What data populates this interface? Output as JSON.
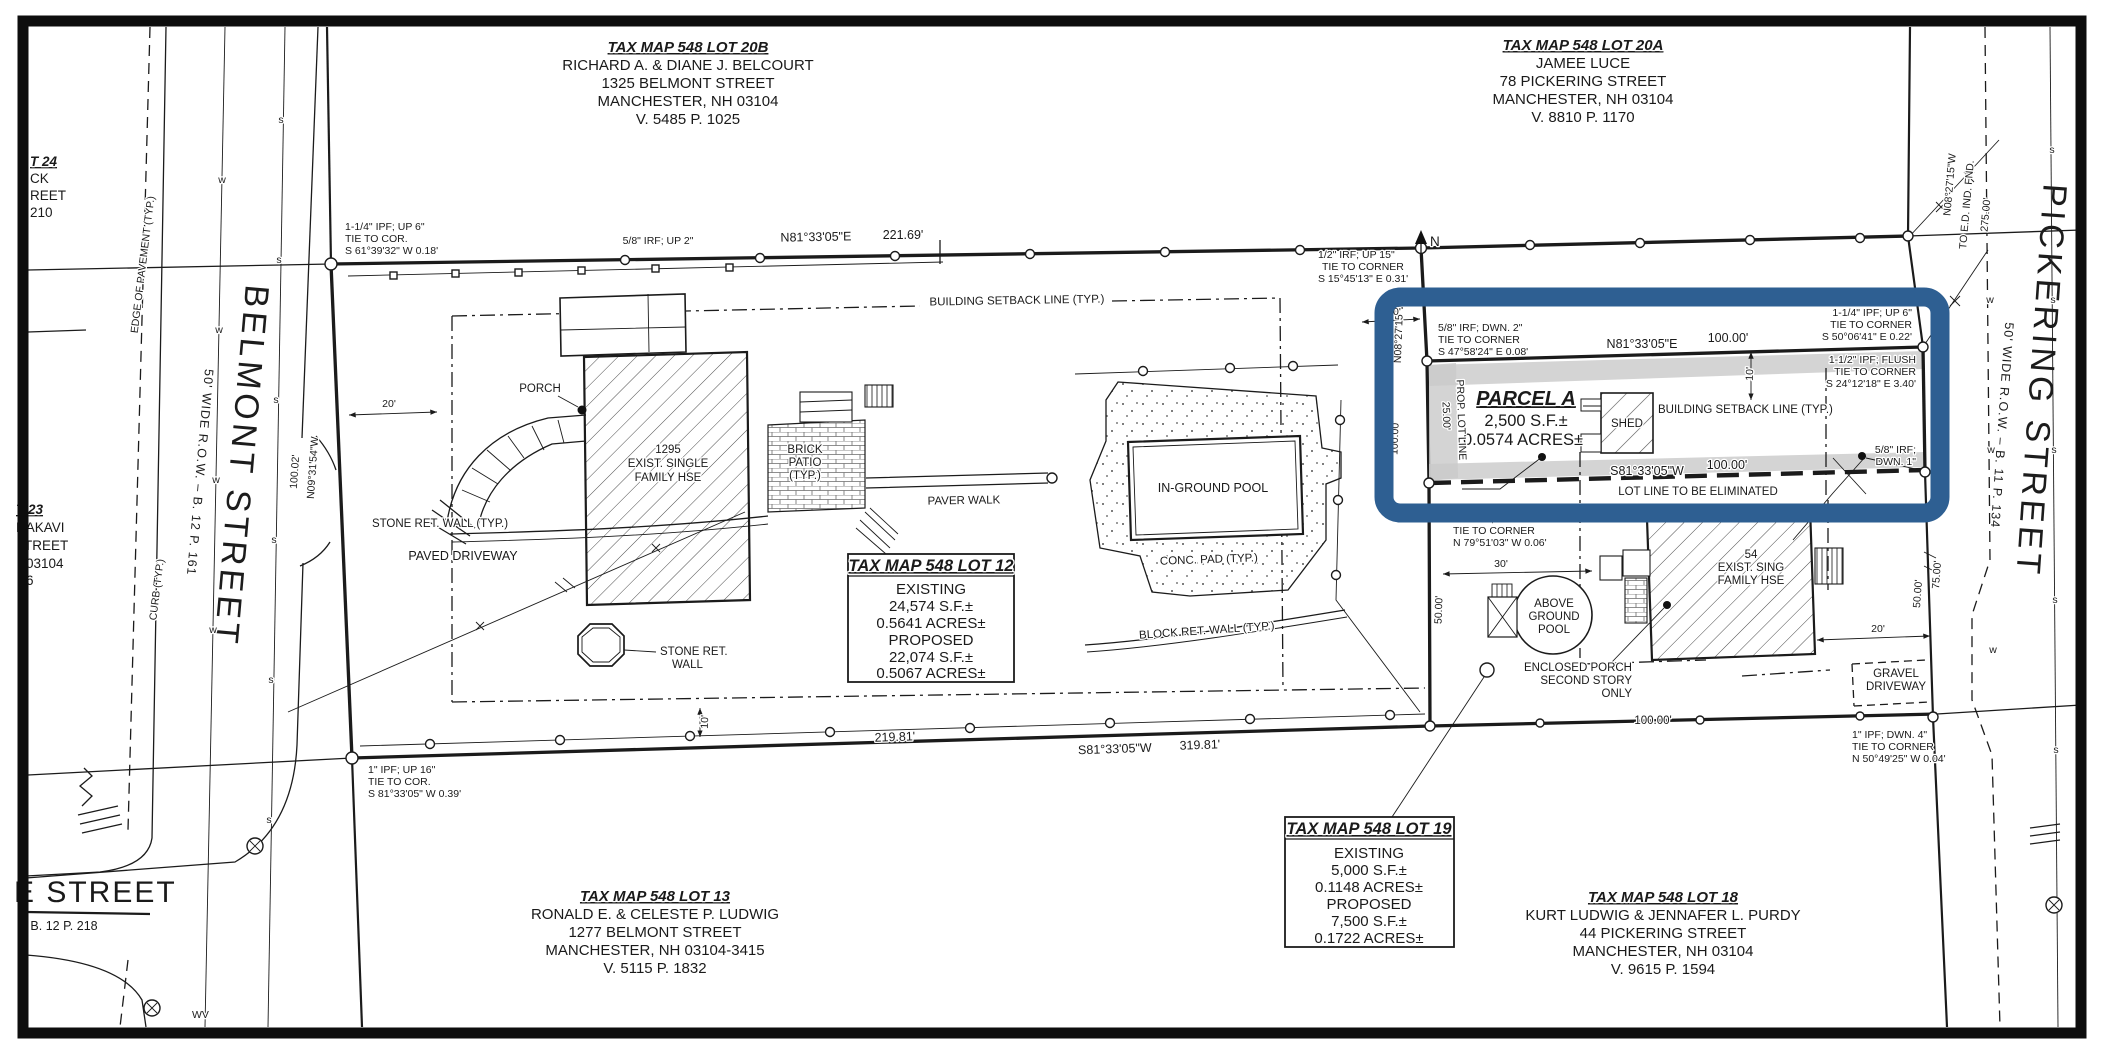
{
  "colors": {
    "highlight": "#2e5f92",
    "paper": "#ffffff",
    "ink": "#1a1a1a"
  },
  "owner_blocks": {
    "lot20b": {
      "title": "TAX MAP 548 LOT 20B",
      "lines": [
        "RICHARD A. & DIANE J. BELCOURT",
        "1325 BELMONT STREET",
        "MANCHESTER, NH 03104",
        "V. 5485 P. 1025"
      ]
    },
    "lot20a": {
      "title": "TAX MAP 548 LOT 20A",
      "lines": [
        "JAMEE LUCE",
        "78 PICKERING STREET",
        "MANCHESTER, NH 03104",
        "V. 8810 P. 1170"
      ]
    },
    "lot13": {
      "title": "TAX MAP 548 LOT 13",
      "lines": [
        "RONALD E. & CELESTE P. LUDWIG",
        "1277 BELMONT STREET",
        "MANCHESTER, NH 03104-3415",
        "V. 5115  P. 1832"
      ]
    },
    "lot18": {
      "title": "TAX MAP 548 LOT 18",
      "lines": [
        "KURT LUDWIG & JENNAFER L. PURDY",
        "44 PICKERING STREET",
        "MANCHESTER, NH 03104",
        "V. 9615 P. 1594"
      ]
    }
  },
  "area_boxes": {
    "lot12": {
      "title": "TAX MAP 548 LOT 12",
      "rows": [
        "EXISTING",
        "24,574 S.F.±",
        "0.5641 ACRES±",
        "PROPOSED",
        "22,074 S.F.±",
        "0.5067 ACRES±"
      ]
    },
    "lot19": {
      "title": "TAX MAP 548 LOT 19",
      "rows": [
        "EXISTING",
        "5,000 S.F.±",
        "0.1148 ACRES±",
        "PROPOSED",
        "7,500 S.F.±",
        "0.1722 ACRES±"
      ]
    }
  },
  "parcel_a": {
    "name": "PARCEL A",
    "area_sf": "2,500 S.F.±",
    "area_acres": "0.0574 ACRES±",
    "shed": "SHED",
    "prop_lot_line": "PROP. LOT LINE",
    "eliminate": "LOT LINE TO BE ELIMINATED"
  },
  "streets": {
    "belmont": {
      "name": "BELMONT STREET",
      "row": "50' WIDE R.O.W. – B. 12 P. 161"
    },
    "pickering": {
      "name": "PICKERING STREET",
      "row": "50' WIDE R.O.W. – B. 11 P. 134"
    },
    "e_street": {
      "name": "E STREET",
      "row": "– B. 12 P. 218"
    },
    "edge_of_pavement": "EDGE OF PAVEMENT (TYP.)",
    "curb": "CURB (TYP.)",
    "wv": "WV",
    "sewer_mark": "s",
    "water_mark": "w"
  },
  "bearings": {
    "n81": "N81°33'05\"E",
    "s81": "S81°33'05\"W",
    "n08": "N08°27'15\"W",
    "n09": "N09°31'54\"W"
  },
  "dims": {
    "d10": "10'",
    "d20": "20'",
    "d25": "25.00'",
    "d30": "30'",
    "d50": "50.00'",
    "d75": "75.00'",
    "d100": "100.00'",
    "d10002": "100.02'",
    "d21981": "219.81'",
    "d22169": "221.69'",
    "d27500": "275.00'",
    "d31981": "319.81'"
  },
  "monument_notes": {
    "ipf_up6_nw": [
      "1-1/4\" IPF; UP 6\"",
      "TIE TO COR.",
      "S 61°39'32\" W 0.18'"
    ],
    "irf_up2": "5/8\" IRF; UP 2\"",
    "irf_up15": [
      "1/2\" IRF; UP 15\"",
      "TIE TO CORNER",
      "S 15°45'13\" E 0.31'"
    ],
    "irf_dwn2": [
      "5/8\" IRF; DWN. 2\"",
      "TIE TO CORNER",
      "S 47°58'24\" E 0.08'"
    ],
    "ipf_up6_ne": [
      "1-1/4\" IPF; UP 6\"",
      "TIE TO CORNER",
      "S 50°06'41\" E 0.22'"
    ],
    "ipf_flush": [
      "1-1/2\" IPF; FLUSH",
      "TIE TO CORNER",
      "S 24°12'18\" E 3.40'"
    ],
    "irf_dwn1": [
      "5/8\" IRF;",
      "DWN. 1\""
    ],
    "irf_dwn3": [
      "5/8\" IRF; DWN. 3\"",
      "TIE TO CORNER",
      "N 79°51'03\" W 0.06'"
    ],
    "ipf_up16": [
      "1\" IPF; UP 16\"",
      "TIE TO COR.",
      "S 81°33'05\" W 0.39'"
    ],
    "ipf_dwn4": [
      "1\" IPF; DWN. 4\"",
      "TIE TO CORNER",
      "N 50°49'25\" W 0.04'"
    ]
  },
  "features": {
    "setback": "BUILDING SETBACK LINE (TYP.)",
    "porch": "PORCH",
    "house12": [
      "1295",
      "EXIST. SINGLE",
      "FAMILY HSE"
    ],
    "stone_wall": "STONE RET. WALL (TYP.)",
    "paved_driveway": "PAVED DRIVEWAY",
    "brick_patio": [
      "BRICK",
      "PATIO",
      "(TYP.)"
    ],
    "paver_walk": "PAVER WALK",
    "inground_pool": "IN-GROUND POOL",
    "conc_pad": "CONC. PAD (TYP.)",
    "block_wall": "BLOCK RET. WALL (TYP.)",
    "stone_wall2": [
      "STONE RET.",
      "WALL"
    ],
    "above_pool": [
      "ABOVE",
      "GROUND",
      "POOL"
    ],
    "enclosed_porch": [
      "ENCLOSED PORCH",
      "SECOND STORY",
      "ONLY"
    ],
    "house54": [
      "54",
      "EXIST. SING",
      "FAMILY HSE"
    ],
    "gravel": [
      "GRAVEL",
      "DRIVEWAY"
    ]
  },
  "misc": {
    "to_ed": "TO E.D. IND. FND.",
    "north": "N"
  },
  "partial_left": {
    "lot24": [
      "T 24",
      "CK",
      "REET",
      "210"
    ],
    "lot23": [
      "T 23",
      "HAKAVI",
      "TREET",
      "03104",
      "6"
    ]
  }
}
